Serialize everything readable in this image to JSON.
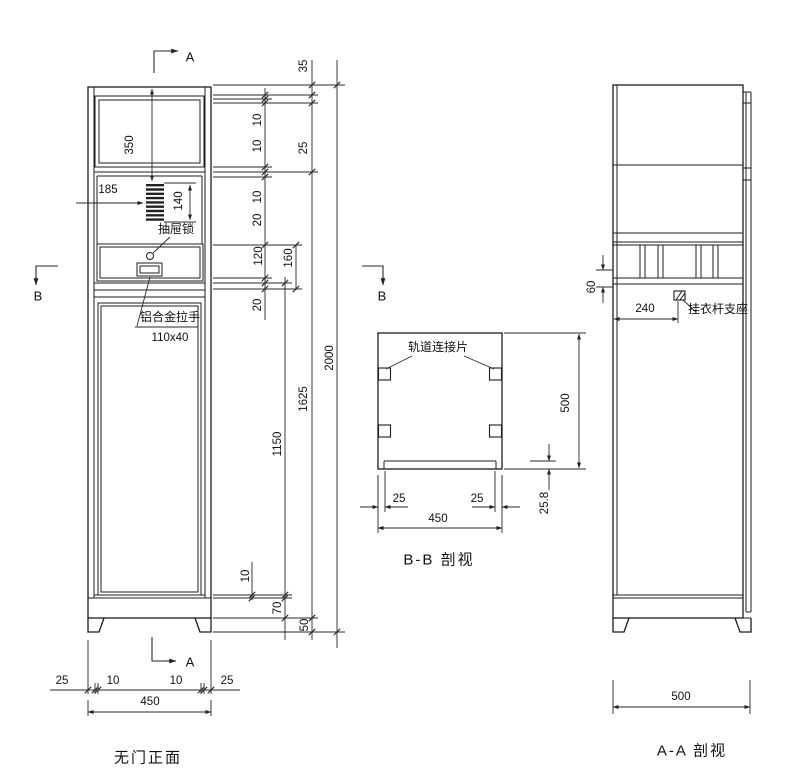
{
  "markers": {
    "a": "A",
    "b": "B"
  },
  "front": {
    "caption": "无门正面",
    "labels": {
      "lock": "抽屉锁",
      "handle": "铝合金拉手",
      "handle_size": "110x40"
    },
    "dims": {
      "top_box_height": "350",
      "vent_offset": "185",
      "vent_height": "140",
      "d35": "35",
      "d10a": "10",
      "d10b": "10",
      "d25": "25",
      "d10c": "10",
      "d20a": "20",
      "drawer_inner": "120",
      "drawer_front": "160",
      "d20b": "20",
      "lower_panel": "1150",
      "body": "1625",
      "total": "2000",
      "d10d": "10",
      "plinth": "70",
      "foot": "50",
      "foot_inset_l": "25",
      "foot_w_l": "10",
      "foot_w_r": "10",
      "foot_inset_r": "25",
      "width": "450"
    }
  },
  "section_bb": {
    "caption": "B-B 剖视",
    "labels": {
      "track": "轨道连接片"
    },
    "dims": {
      "inset_left": "25",
      "inset_right": "25",
      "width": "450",
      "height": "500",
      "base": "25.8"
    }
  },
  "section_aa": {
    "caption": "A-A 剖视",
    "labels": {
      "support": "挂衣杆支座"
    },
    "dims": {
      "rail": "60",
      "support_offset": "240",
      "depth": "500"
    }
  }
}
